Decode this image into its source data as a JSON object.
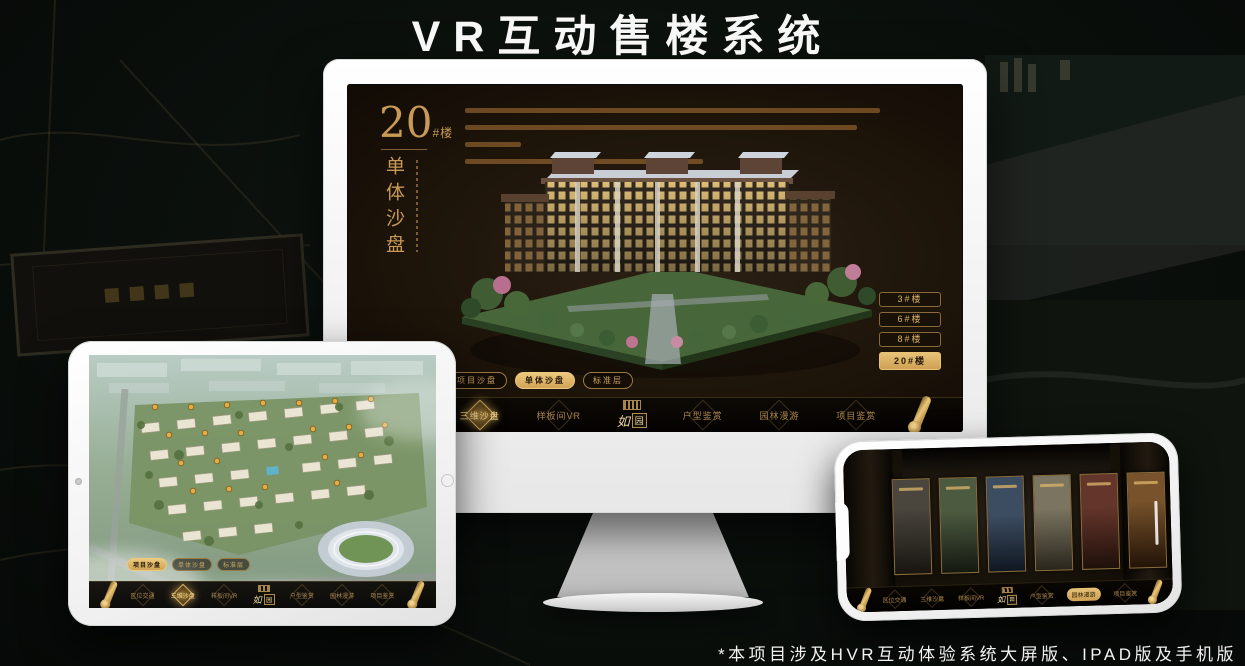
{
  "title": "VR互动售楼系统",
  "footnote": "*本项目涉及HVR互动体验系统大屏版、IPAD版及手机版",
  "colors": {
    "gold": "#c9a05e",
    "gold_bright": "#e7c277",
    "screen_bg": "#1c1309",
    "page_bg": "#0a0f0c"
  },
  "nav": {
    "items": [
      "区位交通",
      "三维沙盘",
      "样板间VR",
      "户型鉴赏",
      "园林漫游",
      "项目鉴赏"
    ],
    "logo_first": "如",
    "logo_second": "园"
  },
  "monitor": {
    "hero_number": "20",
    "hero_unit": "#楼",
    "hero_subtitle": "单体沙盘",
    "floor_buttons": [
      {
        "label": "3#楼",
        "active": false
      },
      {
        "label": "6#楼",
        "active": false
      },
      {
        "label": "8#楼",
        "active": false
      },
      {
        "label": "20#楼",
        "active": true
      }
    ],
    "sub_tabs": [
      {
        "label": "项目沙盘",
        "active": false
      },
      {
        "label": "单体沙盘",
        "active": true
      },
      {
        "label": "标准层",
        "active": false
      }
    ],
    "active_nav": "三维沙盘"
  },
  "tablet": {
    "sub_tabs": [
      {
        "label": "项目沙盘",
        "active": true
      },
      {
        "label": "单体沙盘",
        "active": false
      },
      {
        "label": "标准层",
        "active": false
      }
    ],
    "active_nav": "三维沙盘"
  },
  "phone": {
    "active_nav": "园林漫游"
  }
}
